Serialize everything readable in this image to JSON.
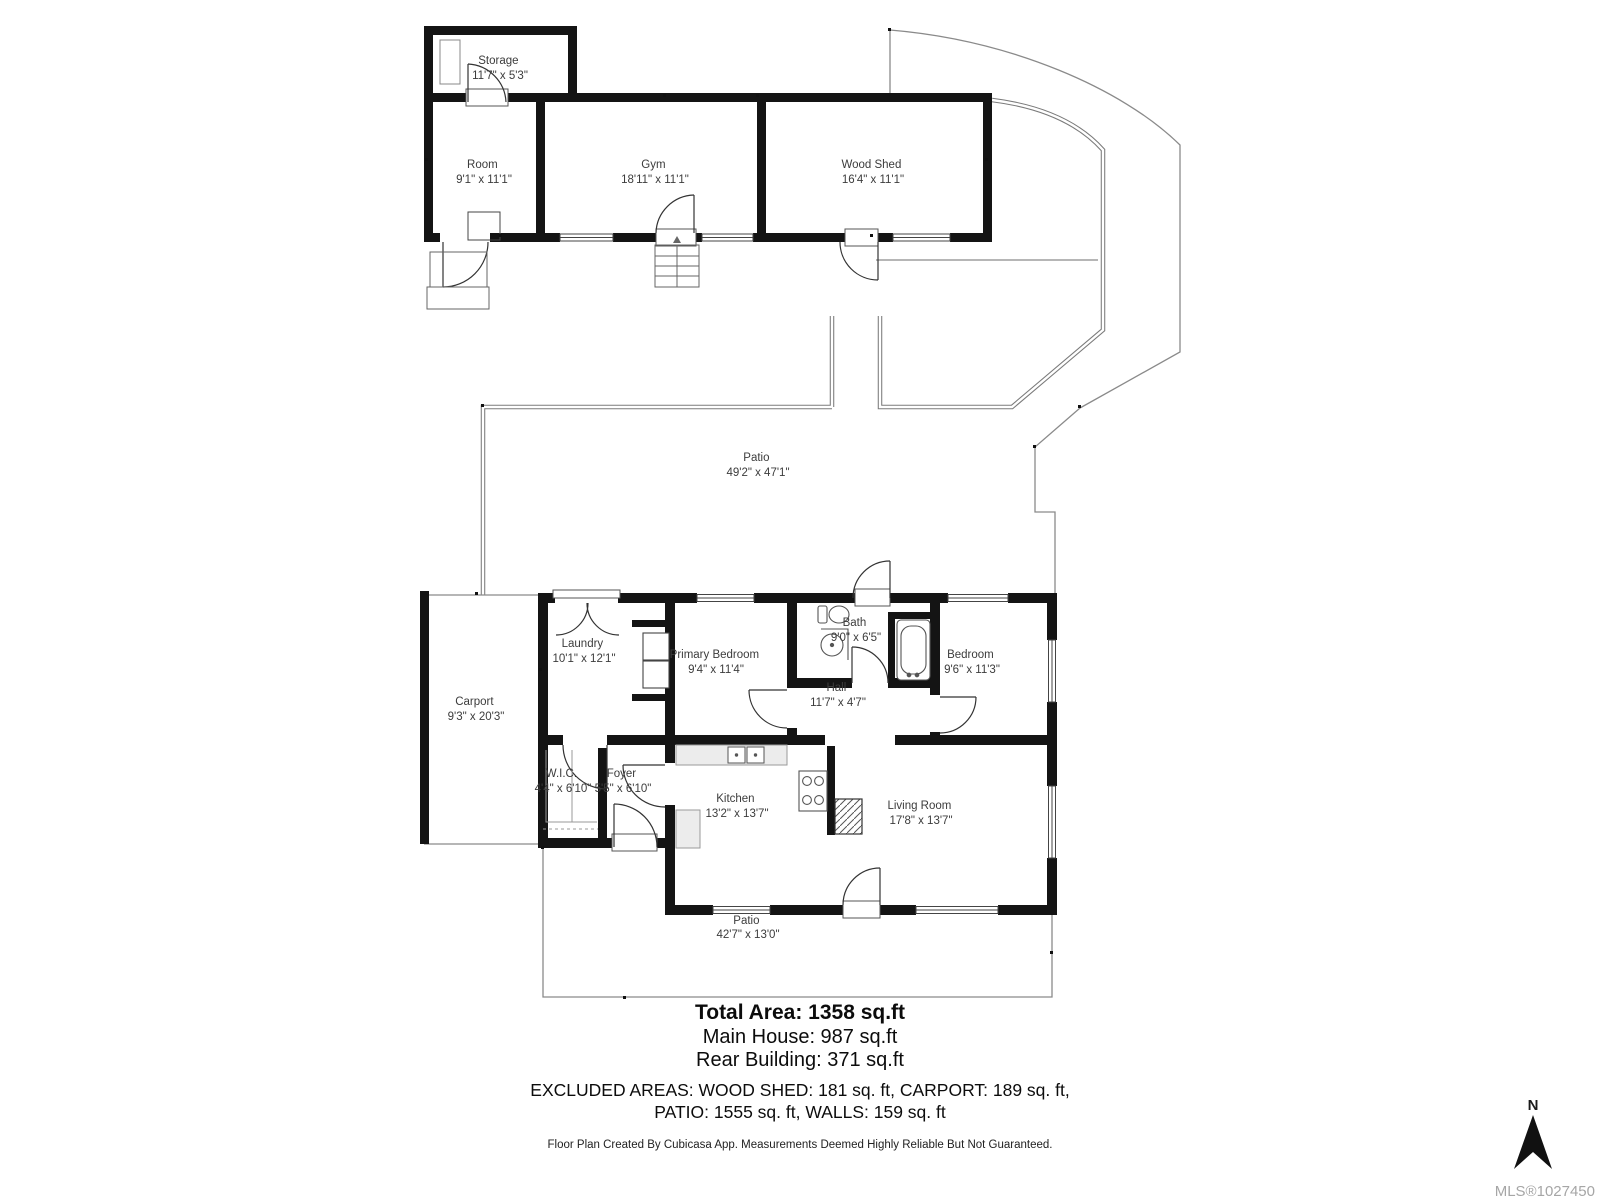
{
  "rooms": {
    "storage": {
      "name": "Storage",
      "dims": "11'7\" x 5'3\""
    },
    "room": {
      "name": "Room",
      "dims": "9'1\" x 11'1\""
    },
    "gym": {
      "name": "Gym",
      "dims": "18'11\" x 11'1\""
    },
    "wood_shed": {
      "name": "Wood Shed",
      "dims": "16'4\" x 11'1\""
    },
    "patio_upper": {
      "name": "Patio",
      "dims": "49'2\" x 47'1\""
    },
    "carport": {
      "name": "Carport",
      "dims": "9'3\" x 20'3\""
    },
    "laundry": {
      "name": "Laundry",
      "dims": "10'1\" x 12'1\""
    },
    "primary_bedroom": {
      "name": "Primary Bedroom",
      "dims": "9'4\" x 11'4\""
    },
    "bath": {
      "name": "Bath",
      "dims": "9'0\" x 6'5\""
    },
    "bedroom": {
      "name": "Bedroom",
      "dims": "9'6\" x 11'3\""
    },
    "hall": {
      "name": "Hall",
      "dims": "11'7\" x 4'7\""
    },
    "wic": {
      "name": "W.I.C.",
      "dims": "4'4\" x 6'10\""
    },
    "foyer": {
      "name": "Foyer",
      "dims": "5'5\" x 6'10\""
    },
    "kitchen": {
      "name": "Kitchen",
      "dims": "13'2\" x 13'7\""
    },
    "living_room": {
      "name": "Living Room",
      "dims": "17'8\" x 13'7\""
    },
    "patio_lower": {
      "name": "Patio",
      "dims": "42'7\" x 13'0\""
    }
  },
  "summary": {
    "total_area": "Total Area: 1358 sq.ft",
    "main_house": "Main House: 987 sq.ft",
    "rear_building": "Rear Building: 371 sq.ft",
    "excluded_line1": "EXCLUDED AREAS: WOOD SHED: 181 sq. ft,  CARPORT: 189 sq. ft,",
    "excluded_line2": "PATIO: 1555 sq. ft, WALLS: 159 sq. ft"
  },
  "footer": {
    "disclaimer": "Floor Plan Created By Cubicasa App. Measurements Deemed Highly Reliable But Not Guaranteed."
  },
  "compass": {
    "label": "N"
  },
  "mls": {
    "number": "MLS®1027450"
  },
  "colors": {
    "wall": "#141414",
    "thin_line": "#8a8a8a",
    "label_text": "#3c3c3c",
    "mls_text": "#a6a6a6"
  }
}
